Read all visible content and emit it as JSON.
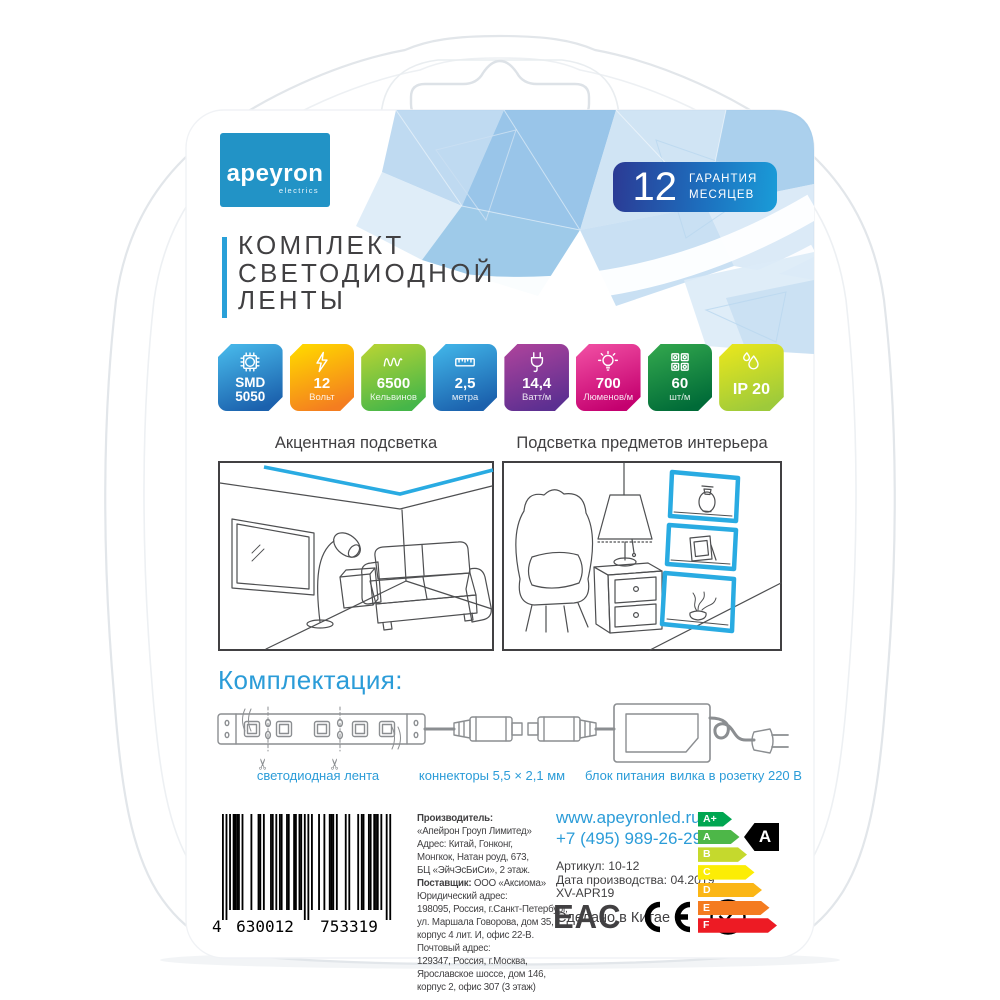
{
  "colors": {
    "accent_blue": "#2b9cd8",
    "strip_blue": "#29abe2",
    "logo_blue": "#2293c6",
    "warranty_gradient": [
      "#2b3a94",
      "#1a9cd8"
    ],
    "dark_text": "#414042"
  },
  "brand": {
    "name": "apeyron",
    "tagline": "electrics"
  },
  "warranty": {
    "number": "12",
    "line1": "ГАРАНТИЯ",
    "line2": "МЕСЯЦЕВ"
  },
  "title": {
    "lines": [
      "КОМПЛЕКТ",
      "СВЕТОДИОДНОЙ",
      "ЛЕНТЫ"
    ]
  },
  "badges": [
    {
      "line1": "SMD",
      "line2": "5050",
      "icon": "led-chip-icon",
      "gradient": [
        "#45b4e7",
        "#1b61ad"
      ],
      "style": "strong2"
    },
    {
      "line1": "12",
      "line2": "Вольт",
      "icon": "lightning-icon",
      "gradient": [
        "#ffd400",
        "#f47d20"
      ],
      "style": ""
    },
    {
      "line1": "6500",
      "line2": "Кельвинов",
      "icon": "color-temp-wave-icon",
      "gradient": [
        "#b0d235",
        "#45b649"
      ],
      "style": ""
    },
    {
      "line1": "2,5",
      "line2": "метра",
      "icon": "ruler-icon",
      "gradient": [
        "#3fb0e5",
        "#1b61ad"
      ],
      "style": ""
    },
    {
      "line1": "14,4",
      "line2": "Ватт/м",
      "icon": "power-plug-icon",
      "gradient": [
        "#a8429b",
        "#5c2f91"
      ],
      "style": ""
    },
    {
      "line1": "700",
      "line2": "Люменов/м",
      "icon": "bulb-icon",
      "gradient": [
        "#ee4aa0",
        "#c4006f"
      ],
      "style": ""
    },
    {
      "line1": "60",
      "line2": "шт/м",
      "icon": "led-grid-icon",
      "gradient": [
        "#2fa34c",
        "#006b38"
      ],
      "style": ""
    },
    {
      "line1": "IP 20",
      "line2": "",
      "icon": "water-drops-icon",
      "gradient": [
        "#e5e51e",
        "#9dca3b"
      ],
      "style": "single"
    }
  ],
  "panels": {
    "left": {
      "caption": "Акцентная подсветка"
    },
    "right": {
      "caption": "Подсветка предметов интерьера"
    }
  },
  "kit": {
    "heading": "Комплектация:",
    "items": [
      {
        "label": "светодиодная лента"
      },
      {
        "label": "коннекторы 5,5 × 2,1 мм"
      },
      {
        "label": "блок питания"
      },
      {
        "label": "вилка в розетку 220 В"
      }
    ]
  },
  "barcode": {
    "first_digit": "4",
    "group1": "630012",
    "group2": "753319"
  },
  "manufacturer": {
    "lines": [
      {
        "bold": "Производитель:",
        "text": ""
      },
      {
        "text": "«Апейрон Гроуп Лимитед»"
      },
      {
        "text": "Адрес: Китай, Гонконг,"
      },
      {
        "text": "Монгкок, Натан роуд, 673,"
      },
      {
        "text": "БЦ «ЭйчЭсБиСи», 2 этаж."
      },
      {
        "bold": "Поставщик:",
        "text": " ООО «Аксиома»"
      },
      {
        "text": "Юридический адрес:"
      },
      {
        "text": "198095, Россия, г.Санкт-Петербург,"
      },
      {
        "text": "ул. Маршала Говорова, дом 35,"
      },
      {
        "text": "корпус 4 лит. И, офис 22-В."
      },
      {
        "text": "Почтовый адрес:"
      },
      {
        "text": "129347, Россия, г.Москва,"
      },
      {
        "text": "Ярославское шоссе, дом 146,"
      },
      {
        "text": "корпус 2, офис 307 (3 этаж)"
      }
    ]
  },
  "contact": {
    "website": "www.apeyronled.ru",
    "phone": "+7 (495) 989-26-29",
    "article": "Артикул: 10-12",
    "production_date": "Дата производства: 04.2019",
    "batch_code": "XV-APR19",
    "made_in": "Сделано в Китае"
  },
  "certifications": {
    "eac": "EAC",
    "ce": "CE",
    "rohs": "RoHS"
  },
  "energy_label": {
    "current_class": "A",
    "classes": [
      {
        "label": "A+",
        "color": "#00a651"
      },
      {
        "label": "A",
        "color": "#4db748"
      },
      {
        "label": "B",
        "color": "#c5d92d"
      },
      {
        "label": "C",
        "color": "#fced05"
      },
      {
        "label": "D",
        "color": "#fbb615"
      },
      {
        "label": "E",
        "color": "#f47b20"
      },
      {
        "label": "F",
        "color": "#ed1b24"
      }
    ]
  }
}
